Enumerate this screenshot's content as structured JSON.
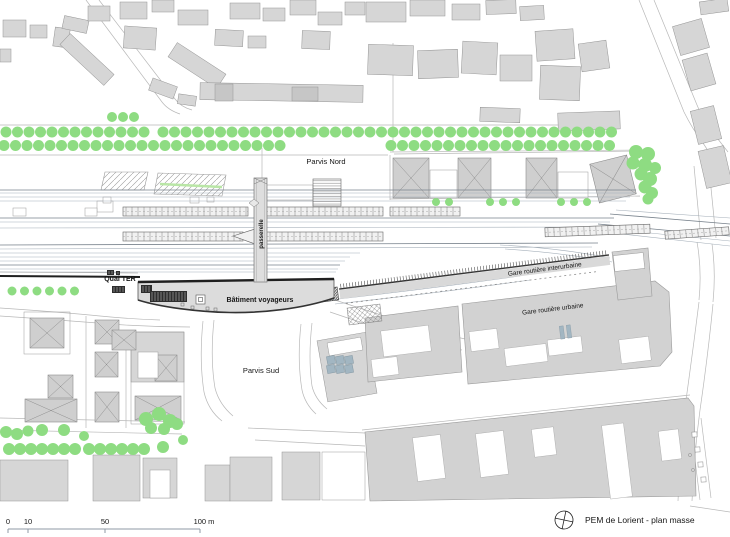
{
  "title_block": {
    "title": "PEM de Lorient - plan masse"
  },
  "scale_bar": {
    "y_line": 529,
    "x_start": 8,
    "x_end": 200,
    "ticks": [
      {
        "label": "0",
        "x": 8,
        "tx": 8
      },
      {
        "label": "10",
        "x": 28,
        "tx": 28
      },
      {
        "label": "50",
        "x": 105,
        "tx": 105
      },
      {
        "label": "100 m",
        "x": 200,
        "tx": 204
      }
    ]
  },
  "labels": [
    {
      "id": "parvis-nord",
      "text": "Parvis Nord",
      "x": 326,
      "y": 164,
      "rot": 0,
      "bold": false,
      "size": 7.5
    },
    {
      "id": "parvis-sud",
      "text": "Parvis Sud",
      "x": 261,
      "y": 373,
      "rot": 0,
      "bold": false,
      "size": 7.5
    },
    {
      "id": "quai-ter",
      "text": "Quai TER",
      "x": 120,
      "y": 281,
      "rot": 0,
      "bold": true,
      "size": 7
    },
    {
      "id": "batiment-voyageurs",
      "text": "Bâtiment voyageurs",
      "x": 260,
      "y": 302,
      "rot": 0,
      "bold": true,
      "size": 7
    },
    {
      "id": "gare-routiere-interurbaine",
      "text": "Gare routière interurbaine",
      "x": 545,
      "y": 271,
      "rot": -7.5,
      "bold": false,
      "size": 6.5
    },
    {
      "id": "gare-routiere-urbaine",
      "text": "Gare routière urbaine",
      "x": 553,
      "y": 311,
      "rot": -7,
      "bold": false,
      "size": 6.5
    },
    {
      "id": "passerelle",
      "text": "passerelle",
      "x": 263,
      "y": 234,
      "rot": -90,
      "bold": true,
      "size": 6
    }
  ],
  "colors": {
    "background": "#ffffff",
    "building_fill": "#d6d6d6",
    "building_dark": "#c6c6c6",
    "building_stroke": "#949494",
    "tree_green": "#8edc82",
    "parking_green": "#b9e6a6",
    "track_light": "#a6b0ba",
    "track_dark": "#78828c",
    "bold_line": "#1f1f1f",
    "street": "#b8b8b8",
    "hatch": "#8a8a8a",
    "steel_blue": "#a2b6c2",
    "canopy_fill": "#f1f1f1",
    "text": "#161616"
  },
  "map": {
    "streets": [
      "M86,0 L162,102 Q168,110 180,114",
      "M99,0 L175,99 Q181,107 192,110",
      "M0,125 L620,125",
      "M0,155 L388,155",
      "M394,154 L642,151",
      "M639,0 L684,112 Q693,130 703,143 L716,163",
      "M654,0 L697,105 Q704,122 714,134 L728,152",
      "M694,166 L701,240",
      "M709,168 L716,238",
      "M697,242 Q702,270 699,300",
      "M712,244 Q716,272 713,302",
      "M699,302 Q693,350 686,400 Q680,450 678,501",
      "M713,304 Q708,355 700,410 Q694,455 692,501",
      "M203,321 Q199,360 204,392 Q208,410 222,421",
      "M214,320 Q210,358 215,388 Q219,404 233,416",
      "M301,324 Q297,360 302,390 Q305,404 316,414",
      "M312,323 Q308,358 312,386 Q315,399 327,409",
      "M0,418 L185,422",
      "M0,430 L182,434",
      "M248,428 L365,433",
      "M255,440 L365,446",
      "M362,430 L690,395",
      "M0,308 Q60,312 100,316 Q130,319 160,320",
      "M0,316 Q60,320 110,324 Q150,327 190,327",
      "M335,300 Q380,315 420,327 Q450,336 470,340",
      "M330,312 Q370,326 410,337 Q440,346 462,350",
      "M390,155 L390,200",
      "M390,199 L640,196",
      "M390,152 L642,150",
      "M393,43 L393,152",
      "M262,148 L262,178",
      "M86,316 L86,428",
      "M126,330 L126,428",
      "M690,420 L700,500",
      "M701,418 L711,498",
      "M690,506 L730,512"
    ],
    "buildings": [
      [
        3,
        20,
        23,
        17,
        0
      ],
      [
        30,
        25,
        17,
        13,
        0
      ],
      [
        54,
        28,
        15,
        19,
        8
      ],
      [
        0,
        49,
        11,
        13,
        0
      ],
      [
        63,
        18,
        25,
        13,
        12
      ],
      [
        88,
        6,
        22,
        15,
        0
      ],
      [
        120,
        2,
        27,
        17,
        0
      ],
      [
        152,
        0,
        22,
        12,
        0
      ],
      [
        124,
        27,
        32,
        22,
        4
      ],
      [
        57,
        52,
        60,
        15,
        43
      ],
      [
        168,
        57,
        58,
        17,
        33
      ],
      [
        150,
        82,
        26,
        13,
        20
      ],
      [
        178,
        10,
        30,
        15,
        0
      ],
      [
        230,
        3,
        30,
        16,
        0
      ],
      [
        263,
        8,
        22,
        13,
        0
      ],
      [
        290,
        0,
        26,
        15,
        0
      ],
      [
        318,
        12,
        24,
        13,
        0
      ],
      [
        345,
        2,
        20,
        13,
        0
      ],
      [
        215,
        30,
        28,
        16,
        3
      ],
      [
        248,
        36,
        18,
        12,
        0
      ],
      [
        302,
        31,
        28,
        18,
        2
      ],
      [
        200,
        84,
        163,
        17,
        1
      ],
      [
        178,
        95,
        18,
        10,
        8
      ],
      [
        366,
        2,
        40,
        20,
        0
      ],
      [
        410,
        0,
        35,
        16,
        0
      ],
      [
        452,
        4,
        28,
        16,
        0
      ],
      [
        486,
        0,
        30,
        14,
        -2
      ],
      [
        520,
        6,
        24,
        14,
        -3
      ],
      [
        368,
        45,
        45,
        30,
        2
      ],
      [
        418,
        50,
        40,
        28,
        -2
      ],
      [
        462,
        42,
        35,
        32,
        3
      ],
      [
        500,
        55,
        32,
        26,
        0
      ],
      [
        536,
        30,
        38,
        30,
        -4
      ],
      [
        540,
        66,
        40,
        34,
        2
      ],
      [
        580,
        42,
        28,
        28,
        -8
      ],
      [
        558,
        112,
        62,
        18,
        -2
      ],
      [
        480,
        108,
        40,
        14,
        2
      ],
      [
        676,
        22,
        30,
        30,
        -16
      ],
      [
        686,
        56,
        26,
        32,
        -16
      ],
      [
        694,
        108,
        24,
        34,
        -14
      ],
      [
        702,
        148,
        26,
        38,
        -13
      ],
      [
        700,
        0,
        28,
        13,
        -8
      ],
      [
        0,
        460,
        68,
        41,
        0
      ],
      [
        93,
        455,
        47,
        46,
        0
      ],
      [
        143,
        458,
        34,
        40,
        0
      ],
      [
        205,
        465,
        25,
        36,
        0
      ],
      [
        230,
        457,
        42,
        44,
        0
      ],
      [
        282,
        452,
        38,
        48,
        0
      ],
      [
        131,
        332,
        53,
        50,
        0
      ],
      [
        322,
        336,
        50,
        62,
        -10
      ]
    ],
    "buildings_dark": [
      [
        215,
        84,
        18,
        17,
        0
      ],
      [
        292,
        87,
        26,
        14,
        0
      ]
    ],
    "white_rects": [
      [
        430,
        170,
        27,
        28,
        0
      ],
      [
        558,
        172,
        30,
        26,
        0
      ],
      [
        150,
        470,
        20,
        28,
        0
      ],
      [
        138,
        352,
        20,
        26,
        0
      ],
      [
        614,
        254,
        30,
        16,
        -6
      ],
      [
        97,
        201,
        16,
        11,
        0
      ],
      [
        13,
        208,
        13,
        8,
        0
      ],
      [
        85,
        208,
        12,
        8,
        0
      ],
      [
        103,
        197,
        8,
        6,
        0
      ],
      [
        190,
        197,
        9,
        6,
        0
      ],
      [
        207,
        197,
        7,
        5,
        0
      ],
      [
        265,
        185,
        48,
        15,
        0
      ],
      [
        265,
        201,
        48,
        8,
        0
      ],
      [
        322,
        452,
        43,
        48,
        0
      ],
      [
        328,
        340,
        34,
        13,
        -10
      ]
    ],
    "plot_outlines": [
      [
        24,
        312,
        46,
        42
      ],
      [
        131,
        332,
        53,
        92
      ]
    ],
    "xroofs": [
      [
        393,
        158,
        36,
        40,
        0
      ],
      [
        458,
        158,
        33,
        40,
        0
      ],
      [
        526,
        158,
        31,
        40,
        0
      ],
      [
        594,
        159,
        38,
        40,
        -14
      ],
      [
        30,
        318,
        34,
        30,
        0
      ],
      [
        95,
        320,
        24,
        24,
        0
      ],
      [
        95,
        352,
        23,
        25,
        0
      ],
      [
        48,
        375,
        25,
        23,
        0
      ],
      [
        25,
        399,
        52,
        23,
        0
      ],
      [
        95,
        392,
        24,
        30,
        0
      ],
      [
        155,
        355,
        22,
        26,
        0
      ],
      [
        135,
        396,
        46,
        24,
        0
      ],
      [
        112,
        330,
        24,
        20,
        0
      ]
    ],
    "urban_polygons": [
      {
        "pts": "365,318 458,306 462,372 368,382"
      },
      {
        "pts": "462,304 655,281 669,292 672,352 660,366 468,384"
      },
      {
        "pts": "365,432 688,398 694,406 696,496 370,501"
      },
      {
        "pts": "612,252 648,248 652,296 618,300"
      }
    ],
    "urban_white": [
      [
        382,
        328,
        48,
        26,
        -7
      ],
      [
        372,
        358,
        26,
        18,
        -7
      ],
      [
        505,
        346,
        42,
        18,
        -7
      ],
      [
        548,
        338,
        34,
        16,
        -7
      ],
      [
        620,
        338,
        30,
        24,
        -7
      ],
      [
        470,
        330,
        28,
        20,
        -7
      ],
      [
        415,
        436,
        28,
        44,
        -7
      ],
      [
        478,
        432,
        28,
        44,
        -7
      ],
      [
        533,
        428,
        22,
        28,
        -7
      ],
      [
        606,
        424,
        22,
        74,
        -7
      ],
      [
        660,
        430,
        20,
        30,
        -7
      ]
    ],
    "panels": {
      "x0": 327,
      "y0": 356,
      "cols": 3,
      "rows": 2,
      "size": 8,
      "gap": 9,
      "rot": -10
    },
    "parking": [
      {
        "pts": "105,172 148,172 144,190 101,190"
      },
      {
        "pts": "158,173 226,175 222,196 154,194"
      }
    ],
    "parking_green_line": [
      160,
      184,
      222,
      187
    ],
    "tracks_light": [
      [
        0,
        193,
        634,
        193
      ],
      [
        0,
        197,
        630,
        197
      ],
      [
        0,
        201,
        626,
        201
      ],
      [
        0,
        222,
        610,
        222
      ],
      [
        0,
        228,
        606,
        227
      ],
      [
        0,
        249,
        592,
        247
      ],
      [
        0,
        253,
        360,
        253
      ],
      [
        0,
        257,
        350,
        257
      ],
      [
        0,
        261,
        345,
        261
      ],
      [
        0,
        269,
        338,
        269
      ],
      [
        0,
        272,
        336,
        272
      ],
      [
        600,
        228,
        730,
        241
      ],
      [
        604,
        232,
        730,
        246
      ],
      [
        616,
        210,
        730,
        218
      ]
    ],
    "tracks_dark": [
      [
        0,
        190,
        636,
        190
      ],
      [
        0,
        218,
        614,
        218
      ],
      [
        0,
        245,
        598,
        243
      ],
      [
        0,
        265,
        340,
        265
      ],
      [
        598,
        224,
        730,
        236
      ],
      [
        610,
        214,
        730,
        224
      ]
    ],
    "track_paths": [
      "M500,245 Q560,248 610,258",
      "M505,249 Q565,253 612,262",
      "M330,300 Q420,290 520,276",
      "M335,304 Q430,294 530,280"
    ],
    "quai_bold": [
      0,
      276,
      140,
      277
    ],
    "quai_thin": [
      0,
      272,
      138,
      273
    ],
    "canopies": [
      [
        123,
        207,
        125,
        9,
        0
      ],
      [
        262,
        207,
        121,
        9,
        0
      ],
      [
        390,
        207,
        70,
        9,
        0
      ],
      [
        123,
        232,
        120,
        9,
        0
      ],
      [
        255,
        232,
        128,
        9,
        0
      ],
      [
        545,
        226,
        105,
        9,
        -2
      ],
      [
        665,
        229,
        64,
        8,
        -4
      ]
    ],
    "canopy_taper": "233,236 255,229 255,244",
    "passerelle": {
      "x": 254,
      "y": 178,
      "w": 13,
      "h": 104
    },
    "north_hatch_rect": [
      313,
      179,
      28,
      27
    ],
    "station": {
      "body": "M138,282 L334,279 L334,298 C302,309 262,313 230,312.5 C198,312 160,307 138,300 Z",
      "top": "M138,282 L334,279",
      "bottom": "M334,298 C302,309 262,313 230,312.5 C198,312 160,307 138,300"
    },
    "station_glyphs_dark": [
      [
        112,
        286,
        13,
        7
      ],
      [
        141,
        285,
        11,
        8
      ],
      [
        150,
        291,
        37,
        11
      ],
      [
        107,
        270,
        7,
        5
      ],
      [
        116,
        271,
        4,
        4
      ]
    ],
    "station_squares": [
      [
        196,
        295,
        9,
        9
      ],
      [
        198.5,
        297.5,
        4,
        4
      ]
    ],
    "station_dots": [
      [
        181,
        303,
        3,
        3
      ],
      [
        191,
        306,
        3,
        3
      ],
      [
        206,
        307,
        3,
        3
      ],
      [
        214,
        308,
        3,
        3
      ]
    ],
    "interurbain": {
      "angle": -7.2,
      "cx": 340,
      "cy": 296,
      "x": 340,
      "y": 284,
      "len": 272,
      "band_h": 9
    },
    "connector_hatch": [
      321,
      288,
      17,
      13,
      -7
    ],
    "lattice": [
      348,
      306,
      33,
      17,
      -7
    ],
    "steel_bars": [
      [
        560,
        326,
        4,
        13,
        -7
      ],
      [
        567,
        325,
        4,
        13,
        -7
      ]
    ],
    "pier_squares": [
      [
        692,
        432,
        5,
        5
      ],
      [
        695,
        447,
        5,
        5
      ],
      [
        698,
        462,
        5,
        5
      ],
      [
        701,
        477,
        5,
        5
      ]
    ],
    "pier_circles": [
      [
        690,
        455
      ],
      [
        693,
        470
      ]
    ],
    "tree_rows": [
      {
        "y": 132,
        "r": 5.5,
        "step": 11.5,
        "segs": [
          [
            6,
            150
          ],
          [
            163,
            620
          ]
        ]
      },
      {
        "y": 145.5,
        "r": 5.5,
        "step": 11.5,
        "segs": [
          [
            4,
            287
          ],
          [
            391,
            620
          ]
        ]
      },
      {
        "y": 117,
        "r": 5,
        "step": 11,
        "segs": [
          [
            112,
            140
          ]
        ]
      },
      {
        "y": 202,
        "r": 4,
        "step": 13,
        "segs": [
          [
            436,
            454
          ],
          [
            490,
            518
          ],
          [
            561,
            590
          ]
        ]
      },
      {
        "y": 291,
        "r": 4.5,
        "step": 12.5,
        "segs": [
          [
            12,
            78
          ]
        ]
      },
      {
        "y": 449,
        "r": 6,
        "step": 11,
        "segs": [
          [
            9,
            78
          ],
          [
            89,
            148
          ]
        ]
      }
    ],
    "tree_singles": [
      [
        636,
        152,
        7
      ],
      [
        648,
        154,
        7
      ],
      [
        633,
        163,
        6.5
      ],
      [
        645,
        165,
        7
      ],
      [
        655,
        168,
        6
      ],
      [
        641,
        174,
        6.5
      ],
      [
        650,
        179,
        7
      ],
      [
        645,
        187,
        6.5
      ],
      [
        652,
        193,
        6
      ],
      [
        648,
        199,
        5.5
      ],
      [
        6,
        432,
        6
      ],
      [
        17,
        434,
        6
      ],
      [
        28,
        431,
        5.5
      ],
      [
        42,
        430,
        6
      ],
      [
        64,
        430,
        6
      ],
      [
        84,
        436,
        5
      ],
      [
        146,
        419,
        7
      ],
      [
        159,
        414,
        7
      ],
      [
        170,
        421,
        7
      ],
      [
        151,
        428,
        6
      ],
      [
        164,
        429,
        6
      ],
      [
        177,
        424,
        6
      ],
      [
        163,
        447,
        6
      ],
      [
        183,
        440,
        5
      ]
    ],
    "compass": {
      "cx": 564,
      "cy": 520,
      "r": 9,
      "rot": 12
    }
  }
}
